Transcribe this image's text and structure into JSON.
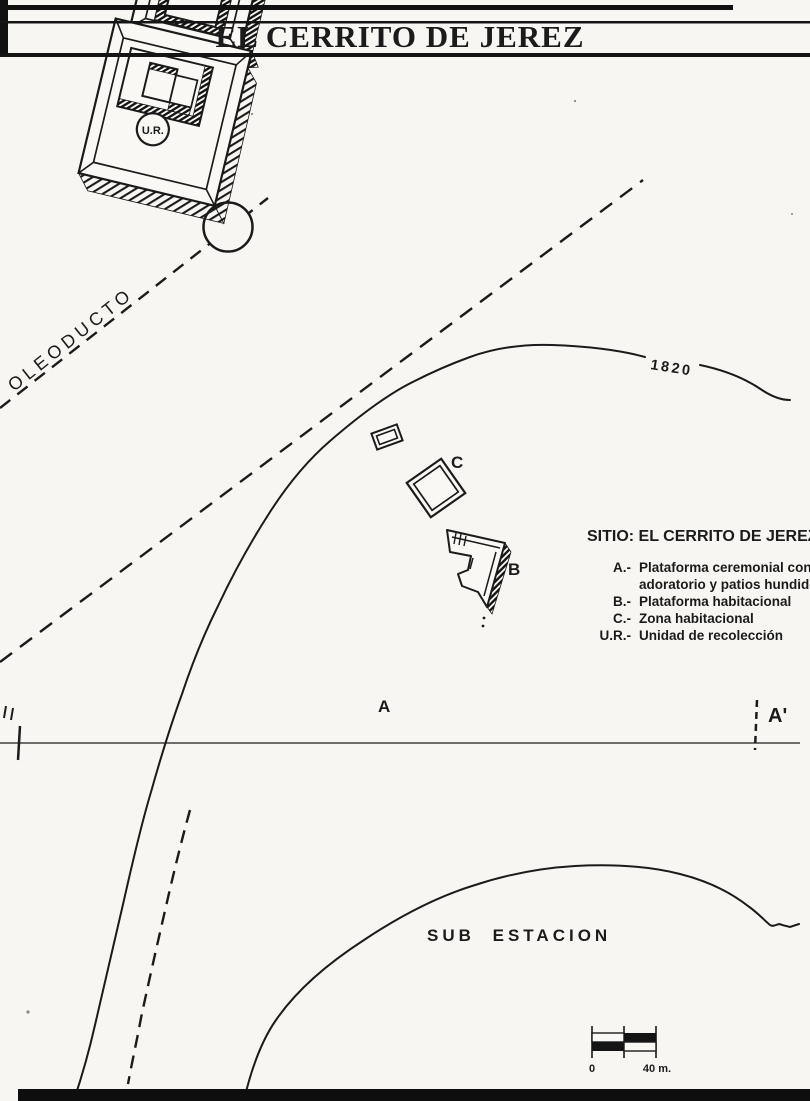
{
  "figure": {
    "title": "EL CERRITO DE JEREZ"
  },
  "map": {
    "pipeline_label": "OLEODUCTO",
    "contour_label": "1820",
    "section": {
      "right_label": "A'"
    },
    "structures": {
      "a_label": "A",
      "b_label": "B",
      "c_label": "C",
      "ur_label": "U.R."
    },
    "area_label": "SUB ESTACION",
    "legend": {
      "site_title": "SITIO: EL CERRITO DE JEREZ",
      "items": [
        {
          "key": "A.-",
          "lines": [
            "Plataforma ceremonial con",
            "adoratorio y patios hundido"
          ]
        },
        {
          "key": "B.-",
          "lines": [
            "Plataforma habitacional"
          ]
        },
        {
          "key": "C.-",
          "lines": [
            "Zona habitacional"
          ]
        },
        {
          "key": "U.R.-",
          "lines": [
            "Unidad de recolección"
          ]
        }
      ]
    },
    "scale_bar": {
      "zero_label": "0",
      "max_label": "40 m."
    },
    "colors": {
      "ink": "#1b1b1b",
      "paper": "#f7f6f2"
    }
  }
}
